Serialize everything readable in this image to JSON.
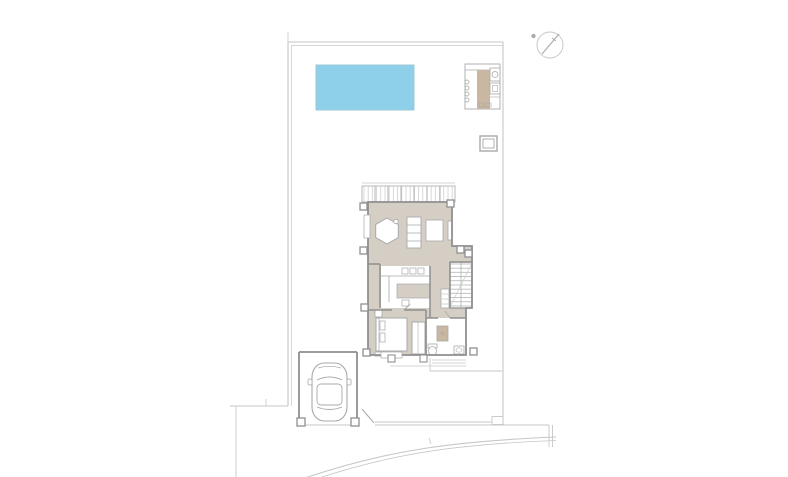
{
  "meta": {
    "description": "architectural-site-plan-drawing",
    "canvas": {
      "width": 788,
      "height": 477
    }
  },
  "colors": {
    "background": "#ffffff",
    "line_light": "#c7c7c7",
    "line_mid": "#a9a9a9",
    "line_dark": "#8f8f8f",
    "floor": "#d4cec5",
    "accent": "#c9b7a1",
    "pool": "#8ed0ea",
    "pool_border": "#9ec7d6",
    "white": "#ffffff"
  },
  "components": {
    "site": [
      "plot-boundary",
      "street-lines",
      "swimming-pool",
      "outdoor-kitchen",
      "utility-box",
      "north-compass",
      "boundary-wall",
      "driveway-gate",
      "parking-bay",
      "car",
      "road-curve"
    ],
    "house": [
      "roof-deck",
      "living-room",
      "dining-table",
      "shelving-unit",
      "rug",
      "living-door",
      "kitchen",
      "kitchen-counter",
      "kitchen-island",
      "kitchen-sink",
      "staircase",
      "stair-radiator",
      "hallway",
      "bedroom",
      "double-bed",
      "pillows",
      "nightstand",
      "wardrobe",
      "bathroom",
      "shower",
      "toilet",
      "washbasin",
      "entry-steps",
      "porch-posts",
      "columns",
      "windows"
    ]
  }
}
